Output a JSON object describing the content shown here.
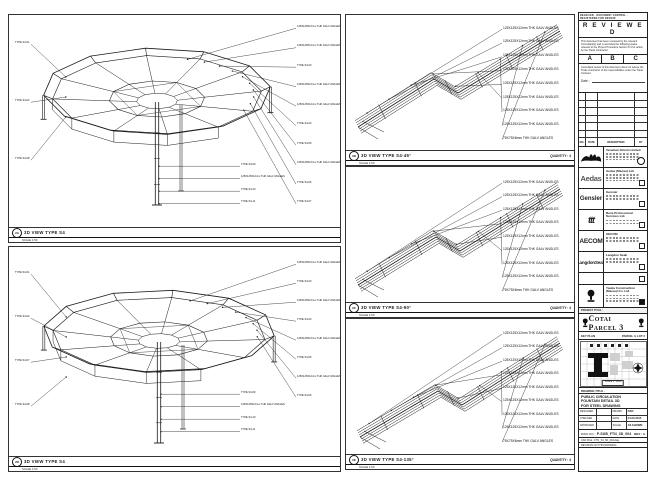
{
  "sheet": {
    "top_note": "RECEIVED · DOCUMENT CONTROL · REGISTERED FOR REVIEW"
  },
  "review": {
    "title": "R E V I E W E D",
    "body": "This document has been reviewed by the relevant Consultant(s) and is accorded the following status relevant to the Project Procedure Section 5.4 for action by the Trade Contractor.",
    "grades": [
      "A",
      "B",
      "C"
    ],
    "note": "Consultant review of this document does not relieve the Trade Contractor of his responsibilities under the Trade Contract.",
    "date_label": "Date :"
  },
  "revisions": {
    "footer": [
      "NO.",
      "DATE",
      "DESCRIPTION",
      "BY"
    ]
  },
  "stakeholders": [
    {
      "kind": "venetian",
      "logo_text": "",
      "name": "Venetian Orient Limited",
      "mark": "stamp"
    },
    {
      "kind": "text-aedas",
      "logo_text": "Aedas",
      "name": "Aedas (Macau) Ltd.",
      "mark": "chk"
    },
    {
      "kind": "text-gensler",
      "logo_text": "Gensler",
      "name": "Gensler",
      "mark": "chk"
    },
    {
      "kind": "text-ttt",
      "logo_text": "ttt",
      "name": "Beca Professional Services Ltd.",
      "mark": "chk"
    },
    {
      "kind": "text-aecom",
      "logo_text": "AECOM",
      "name": "AECOM",
      "mark": "chk"
    },
    {
      "kind": "text-langdon",
      "logo_text": "LangdonSeah",
      "name": "Langdon Seah",
      "mark": "chk"
    },
    {
      "kind": "none",
      "logo_text": "",
      "name": "",
      "mark": "chk"
    },
    {
      "kind": "trophy",
      "logo_text": "",
      "name": "Yauka Construction (Macau) Co. Ltd.",
      "mark": "black"
    }
  ],
  "project": {
    "bar_label": "PROJECT TITLE :",
    "banner": "Cotai Parcel 3"
  },
  "key_plan": {
    "label": "KEY PLAN",
    "right_note": "PARCEL 3, LOT 2",
    "scale_note": "SCALE 1 : 2000"
  },
  "title_block": {
    "label": "DRAWING TITLE :",
    "title_lines": [
      "PUBLIC CIRCULATION",
      "FOUNTAIN DETAIL 3D",
      "FOR STEEL DRAWING"
    ],
    "fields": [
      [
        "DESIGNED",
        "-",
        "DRAWN",
        "DAD"
      ],
      [
        "CHECKED",
        "-",
        "DATE",
        "04-03-2015"
      ],
      [
        "APPROVED",
        "-",
        "SCALE",
        "AS SHOWN"
      ]
    ],
    "dwg_label": "DWG NO :",
    "dwg_no": "P-SUB_FTN_3D_004",
    "rev": "REV : A",
    "cad_line": "CAD FILE : FTN_S4_3D_004.dwg",
    "note_line": "REVISION ON THIS DRAWING"
  },
  "panels": [
    {
      "tag": "2A",
      "title": "3D VIEW TYPE S4",
      "scale": "SCALE 1:50",
      "quantity": "",
      "callouts_left": [
        "TYPE S4-01",
        "TYPE S4-02",
        "TYPE S4-08"
      ],
      "callouts_right": [
        "125X125X12mm THK GALV ANGLES",
        "125X125X12mm THK GALV ANGLES",
        "TYPE S4-03",
        "125X125X12mm THK GALV ANGLES",
        "125X125X12mm THK GALV ANGLES",
        "TYPE S4-04",
        "TYPE S4-05",
        "125X125X12mm THK GALV ANGLES",
        "TYPE S4-06",
        "TYPE S4-07"
      ],
      "callouts_bottom": [
        "TYPE S4-09",
        "125X125X12mm THK GALV ANGLES",
        "TYPE S4-10",
        "TYPE S4-11"
      ]
    },
    {
      "tag": "2B",
      "title": "3D VIEW TYPE S4-45°",
      "scale": "SCALE 1:50",
      "quantity": "QUANTITY : 4",
      "callouts_right": [
        "125X125X12mm THK GALV ANGLES",
        "125X125X12mm THK GALV ANGLES",
        "125X125X12mm THK GALV ANGLES",
        "125X125X12mm THK GALV ANGLES",
        "125X125X12mm THK GALV ANGLES",
        "125X125X12mm THK GALV ANGLES",
        "125X125X12mm THK GALV ANGLES",
        "125X125X12mm THK GALV ANGLES",
        "75X75X6mm THK GALV ANGLES"
      ]
    },
    {
      "tag": "2C",
      "title": "3D VIEW TYPE S4-90°",
      "scale": "SCALE 1:50",
      "quantity": "QUANTITY : 4",
      "callouts_right": [
        "125X125X12mm THK GALV ANGLES",
        "125X125X12mm THK GALV ANGLES",
        "125X125X12mm THK GALV ANGLES",
        "125X125X12mm THK GALV ANGLES",
        "125X125X12mm THK GALV ANGLES",
        "125X125X12mm THK GALV ANGLES",
        "125X125X12mm THK GALV ANGLES",
        "125X125X12mm THK GALV ANGLES",
        "75X75X6mm THK GALV ANGLES"
      ]
    },
    {
      "tag": "2D",
      "title": "3D VIEW TYPE S4",
      "scale": "SCALE 1:50",
      "quantity": "",
      "callouts_left": [
        "TYPE S4-01",
        "TYPE S4-02",
        "TYPE S4-07",
        "TYPE S4-08"
      ],
      "callouts_right": [
        "125X125X12mm THK GALV ANGLES",
        "TYPE S4-03",
        "125X125X12mm THK GALV ANGLES",
        "TYPE S4-04",
        "125X125X12mm THK GALV ANGLES",
        "TYPE S4-05",
        "125X125X12mm THK GALV ANGLES",
        "TYPE S4-06"
      ],
      "callouts_bottom": [
        "TYPE S4-09",
        "125X125X12mm THK GALV ANGLES",
        "TYPE S4-10",
        "TYPE S4-11"
      ]
    },
    {
      "tag": "2E",
      "title": "3D VIEW TYPE S4-135°",
      "scale": "SCALE 1:50",
      "quantity": "QUANTITY : 4",
      "callouts_right": [
        "125X125X12mm THK GALV ANGLES",
        "125X125X12mm THK GALV ANGLES",
        "125X125X12mm THK GALV ANGLES",
        "125X125X12mm THK GALV ANGLES",
        "125X125X12mm THK GALV ANGLES",
        "125X125X12mm THK GALV ANGLES",
        "125X125X12mm THK GALV ANGLES",
        "125X125X12mm THK GALV ANGLES",
        "75X75X6mm THK GALV ANGLES"
      ]
    }
  ]
}
